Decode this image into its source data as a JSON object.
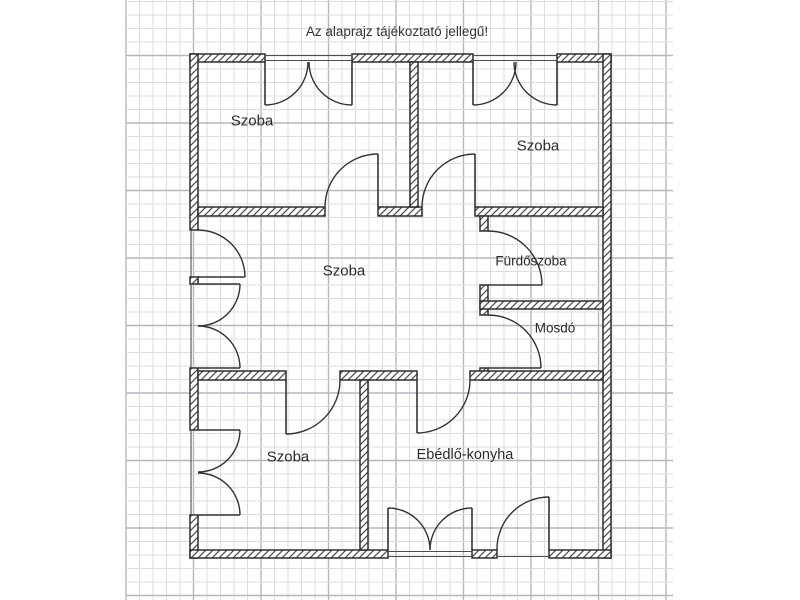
{
  "title": "Az alaprajz tájékoztató jellegű!",
  "colors": {
    "background": "#ffffff",
    "grid_minor": "#dcdce0",
    "grid_major": "#b6b6bd",
    "wall_outline": "#2e2e2e",
    "wall_hatch": "#4a4a4a",
    "symbol_line": "#333333",
    "label_text": "#2b2b2b"
  },
  "grid": {
    "x0": 126,
    "x1": 673,
    "y0": 0,
    "y1": 600,
    "step": 13.5,
    "major_every": 5,
    "v_major_offset": 0,
    "h_major_offset": 4
  },
  "rooms": [
    {
      "id": "szoba-top-left",
      "label": "Szoba",
      "x": 252,
      "y": 120,
      "size": 15
    },
    {
      "id": "szoba-top-right",
      "label": "Szoba",
      "x": 538,
      "y": 145,
      "size": 15
    },
    {
      "id": "szoba-middle",
      "label": "Szoba",
      "x": 344,
      "y": 270,
      "size": 15
    },
    {
      "id": "furdoszoba",
      "label": "Fürdőszoba",
      "x": 531,
      "y": 261,
      "size": 13.5
    },
    {
      "id": "mosdo",
      "label": "Mosdó",
      "x": 555,
      "y": 328,
      "size": 13.5
    },
    {
      "id": "szoba-bottom-left",
      "label": "Szoba",
      "x": 288,
      "y": 456,
      "size": 15
    },
    {
      "id": "ebedlo-konyha",
      "label": "Ebédlő-konyha",
      "x": 465,
      "y": 454,
      "size": 14.5
    }
  ],
  "plan": {
    "walls": [
      {
        "x": 190,
        "y": 54,
        "w": 75,
        "h": 8
      },
      {
        "x": 352,
        "y": 54,
        "w": 121,
        "h": 8
      },
      {
        "x": 557,
        "y": 54,
        "w": 54,
        "h": 8
      },
      {
        "x": 190,
        "y": 54,
        "w": 8,
        "h": 176
      },
      {
        "x": 190,
        "y": 277,
        "w": 8,
        "h": 7
      },
      {
        "x": 190,
        "y": 368,
        "w": 8,
        "h": 62
      },
      {
        "x": 190,
        "y": 515,
        "w": 8,
        "h": 43
      },
      {
        "x": 603,
        "y": 54,
        "w": 8,
        "h": 504
      },
      {
        "x": 190,
        "y": 550,
        "w": 198,
        "h": 8
      },
      {
        "x": 472,
        "y": 550,
        "w": 25,
        "h": 8
      },
      {
        "x": 549,
        "y": 550,
        "w": 62,
        "h": 8
      },
      {
        "x": 198,
        "y": 207,
        "w": 127,
        "h": 9
      },
      {
        "x": 378,
        "y": 207,
        "w": 44,
        "h": 9
      },
      {
        "x": 475,
        "y": 207,
        "w": 128,
        "h": 9
      },
      {
        "x": 410,
        "y": 62,
        "w": 8,
        "h": 145
      },
      {
        "x": 480,
        "y": 216,
        "w": 8,
        "h": 15
      },
      {
        "x": 480,
        "y": 285,
        "w": 8,
        "h": 30
      },
      {
        "x": 480,
        "y": 368,
        "w": 8,
        "h": 12
      },
      {
        "x": 480,
        "y": 301,
        "w": 123,
        "h": 8
      },
      {
        "x": 198,
        "y": 371,
        "w": 88,
        "h": 9
      },
      {
        "x": 340,
        "y": 371,
        "w": 77,
        "h": 9
      },
      {
        "x": 470,
        "y": 371,
        "w": 133,
        "h": 9
      },
      {
        "x": 360,
        "y": 380,
        "w": 8,
        "h": 170
      }
    ],
    "thin_lines": [
      {
        "x1": 265,
        "y1": 55.5,
        "x2": 352,
        "y2": 55.5
      },
      {
        "x1": 265,
        "y1": 60.5,
        "x2": 352,
        "y2": 60.5
      },
      {
        "x1": 473,
        "y1": 55.5,
        "x2": 557,
        "y2": 55.5
      },
      {
        "x1": 473,
        "y1": 60.5,
        "x2": 557,
        "y2": 60.5
      },
      {
        "x1": 388,
        "y1": 551.5,
        "x2": 472,
        "y2": 551.5
      },
      {
        "x1": 388,
        "y1": 556.5,
        "x2": 472,
        "y2": 556.5
      },
      {
        "x1": 497,
        "y1": 556.5,
        "x2": 549,
        "y2": 556.5
      },
      {
        "x1": 191,
        "y1": 230,
        "x2": 191,
        "y2": 277
      },
      {
        "x1": 191,
        "y1": 284,
        "x2": 191,
        "y2": 368
      },
      {
        "x1": 191,
        "y1": 430,
        "x2": 191,
        "y2": 515
      }
    ],
    "leaves": [
      {
        "name": "window-leaf",
        "x1": 265,
        "y1": 62,
        "x2": 265,
        "y2": 105
      },
      {
        "name": "window-leaf",
        "x1": 352,
        "y1": 62,
        "x2": 352,
        "y2": 105
      },
      {
        "name": "window-leaf",
        "x1": 473,
        "y1": 62,
        "x2": 473,
        "y2": 105
      },
      {
        "name": "window-leaf",
        "x1": 557,
        "y1": 62,
        "x2": 557,
        "y2": 105
      },
      {
        "name": "door-leaf",
        "x1": 378,
        "y1": 154,
        "x2": 378,
        "y2": 207
      },
      {
        "name": "door-leaf",
        "x1": 475,
        "y1": 154,
        "x2": 475,
        "y2": 207
      },
      {
        "name": "door-leaf",
        "x1": 198,
        "y1": 277,
        "x2": 245,
        "y2": 277
      },
      {
        "name": "door-leaf",
        "x1": 198,
        "y1": 284,
        "x2": 240,
        "y2": 284
      },
      {
        "name": "door-leaf",
        "x1": 198,
        "y1": 368,
        "x2": 240,
        "y2": 368
      },
      {
        "name": "door-leaf",
        "x1": 488,
        "y1": 285,
        "x2": 542,
        "y2": 285
      },
      {
        "name": "door-leaf",
        "x1": 488,
        "y1": 368,
        "x2": 541,
        "y2": 368
      },
      {
        "name": "door-leaf",
        "x1": 286,
        "y1": 380,
        "x2": 286,
        "y2": 434
      },
      {
        "name": "door-leaf",
        "x1": 198,
        "y1": 430,
        "x2": 240,
        "y2": 430
      },
      {
        "name": "door-leaf",
        "x1": 198,
        "y1": 515,
        "x2": 240,
        "y2": 515
      },
      {
        "name": "door-leaf",
        "x1": 417,
        "y1": 380,
        "x2": 417,
        "y2": 433
      },
      {
        "name": "window-leaf",
        "x1": 388,
        "y1": 508,
        "x2": 388,
        "y2": 550
      },
      {
        "name": "window-leaf",
        "x1": 472,
        "y1": 508,
        "x2": 472,
        "y2": 550
      },
      {
        "name": "door-leaf",
        "x1": 549,
        "y1": 497,
        "x2": 549,
        "y2": 550
      }
    ],
    "arcs": [
      {
        "name": "window-swing-arc",
        "d": "M 265 105 A 43 43 0 0 0 308 62"
      },
      {
        "name": "window-swing-arc",
        "d": "M 352 105 A 43 43 0 0 1 309 62"
      },
      {
        "name": "window-swing-arc",
        "d": "M 473 105 A 43 43 0 0 0 516 62"
      },
      {
        "name": "window-swing-arc",
        "d": "M 557 105 A 43 43 0 0 1 514 62"
      },
      {
        "name": "door-swing-arc",
        "d": "M 325 207 A 53 53 0 0 1 378 154"
      },
      {
        "name": "door-swing-arc",
        "d": "M 422 207 A 53 53 0 0 1 475 154"
      },
      {
        "name": "door-swing-arc",
        "d": "M 198 230 A 47 47 0 0 1 245 277"
      },
      {
        "name": "door-swing-arc",
        "d": "M 240 284 A 42 42 0 0 1 198 326"
      },
      {
        "name": "door-swing-arc",
        "d": "M 240 368 A 42 42 0 0 0 198 326"
      },
      {
        "name": "door-swing-arc",
        "d": "M 488 231 A 54 54 0 0 1 542 285"
      },
      {
        "name": "door-swing-arc",
        "d": "M 488 315 A 53 53 0 0 1 541 368"
      },
      {
        "name": "door-swing-arc",
        "d": "M 286 434 A 54 54 0 0 0 340 380"
      },
      {
        "name": "door-swing-arc",
        "d": "M 240 430 A 42 42 0 0 1 198 472"
      },
      {
        "name": "door-swing-arc",
        "d": "M 240 515 A 42 42 0 0 0 198 473"
      },
      {
        "name": "door-swing-arc",
        "d": "M 417 433 A 53 53 0 0 0 470 380"
      },
      {
        "name": "window-swing-arc",
        "d": "M 388 508 A 42 42 0 0 1 430 550"
      },
      {
        "name": "window-swing-arc",
        "d": "M 472 508 A 42 42 0 0 0 430 550"
      },
      {
        "name": "door-swing-arc",
        "d": "M 497 550 A 52 52 0 0 1 549 497"
      }
    ]
  }
}
